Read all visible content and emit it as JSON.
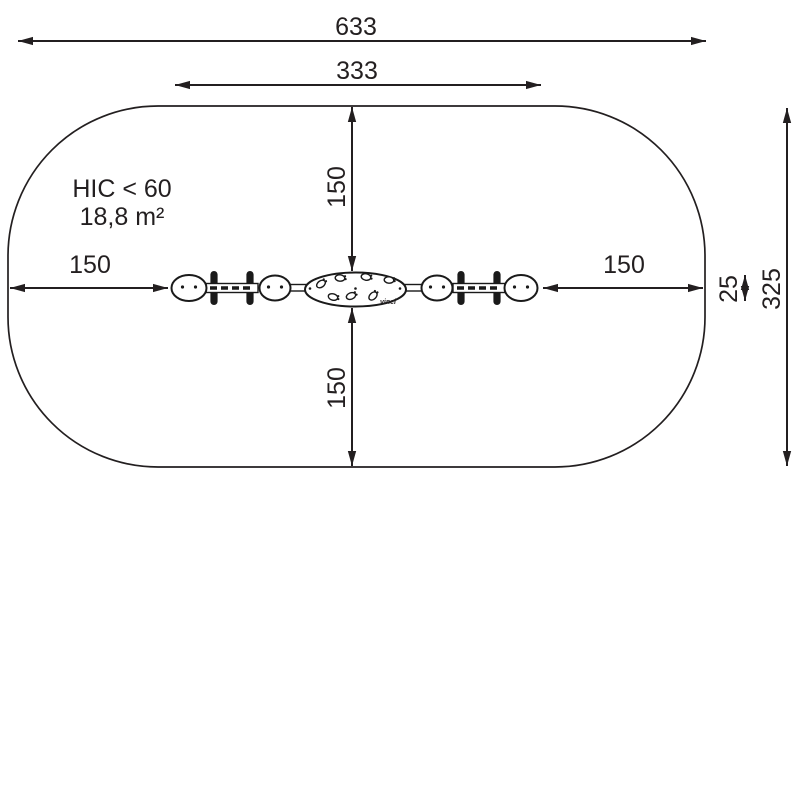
{
  "meta": {
    "title": "Playground equipment safety zone plan view"
  },
  "colors": {
    "ink": "#231f20",
    "background": "#ffffff"
  },
  "dimensions": {
    "total_width": "633",
    "equipment_length": "333",
    "top_clearance": "150",
    "bottom_clearance": "150",
    "left_clearance": "150",
    "right_clearance": "150",
    "equipment_depth": "25",
    "total_depth": "325"
  },
  "annotations": {
    "hic": "HIC < 60",
    "area": "18,8 m²",
    "maker_mark": "vinci"
  }
}
